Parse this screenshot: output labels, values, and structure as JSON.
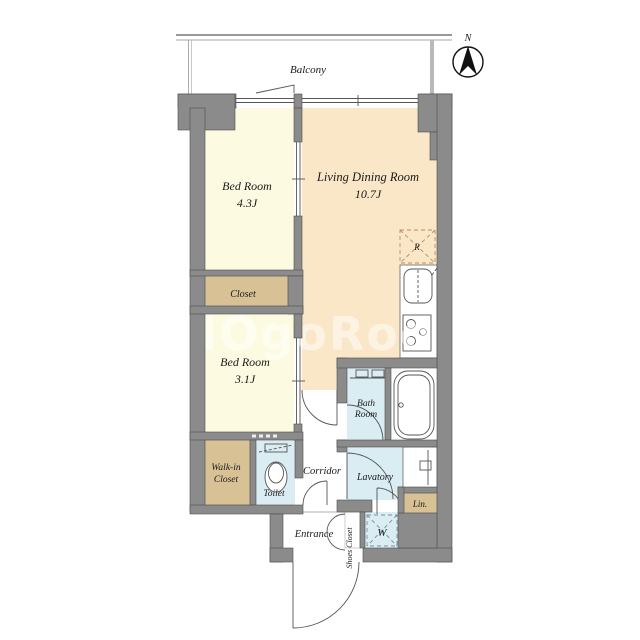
{
  "labels": {
    "balcony": "Balcony",
    "north": "N",
    "bedroom1_name": "Bed Room",
    "bedroom1_size": "4.3J",
    "living_name": "Living Dining Room",
    "living_size": "10.7J",
    "bedroom2_name": "Bed Room",
    "bedroom2_size": "3.1J",
    "closet": "Closet",
    "walkin_line1": "Walk-in",
    "walkin_line2": "Closet",
    "toilet": "Toilet",
    "corridor": "Corridor",
    "bath_line1": "Bath",
    "bath_line2": "Room",
    "lavatory": "Lavatory",
    "linen": "Lin.",
    "entrance": "Entrance",
    "shoes_closet": "Shoes Closet",
    "washer_mark": "W",
    "fridge_mark": "R",
    "watermark": "HOgoRooM"
  },
  "colors": {
    "wall": "#8b8b8b",
    "wall_outline": "#4f4f4f",
    "bedroom_fill": "#fcfbe2",
    "living_fill": "#f9e7c8",
    "closet_fill": "#d8c194",
    "wet_fill": "#d9edf3",
    "fixture_line": "#555555",
    "fridge_dash": "#bf8a5f",
    "washer_dash": "#7d8f9b",
    "text": "#1a1a1a",
    "watermark": "#ffffff"
  }
}
